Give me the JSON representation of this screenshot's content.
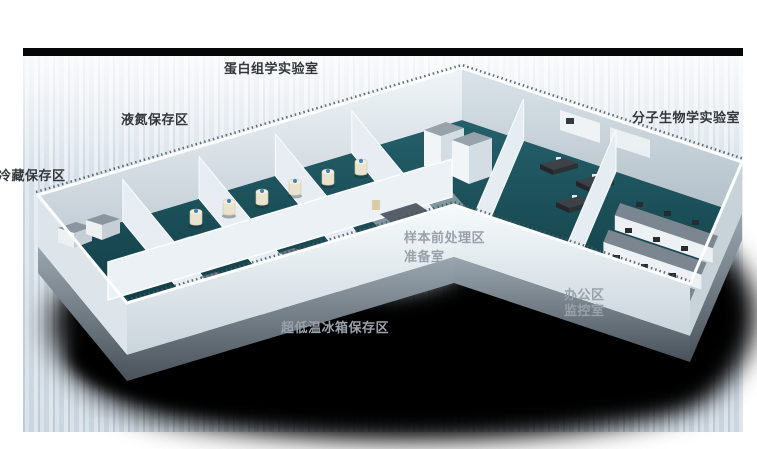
{
  "scene": {
    "description_labels": [
      {
        "id": "proteomics-lab",
        "text": "蛋白组学实验室"
      },
      {
        "id": "liquid-nitrogen-storage",
        "text": "液氮保存区"
      },
      {
        "id": "cold-storage",
        "text": "冷藏保存区"
      },
      {
        "id": "molecular-biology-lab",
        "text": "分子生物学实验室"
      },
      {
        "id": "sample-pretreatment",
        "text": "样本前处理区"
      },
      {
        "id": "prep-room",
        "text": "准备室"
      },
      {
        "id": "office-area",
        "text": "办公区"
      },
      {
        "id": "monitor-room",
        "text": "监控室"
      },
      {
        "id": "ult-freezer-storage",
        "text": "超低温冰箱保存区"
      }
    ],
    "palette": {
      "page_background": "#ffffff",
      "backdrop_light": "#e4ebf1",
      "top_edge_bar": "#070707",
      "floor_teal": "#1b515b",
      "floor_teal_dark": "#0d343c",
      "wall_white": "#eef3f6",
      "wall_shaded": "#b9c5cd",
      "shadow_black": "#000000",
      "label_on_light": "#32373c",
      "label_on_dark": "#99a1aa",
      "tank_body_cream": "#eae3cd",
      "tank_cap_blue": "#3f80c2",
      "freezer_top_gray": "#8b959d",
      "bench_top_gray": "#7b8690",
      "desk_dark": "#3c4248"
    }
  }
}
